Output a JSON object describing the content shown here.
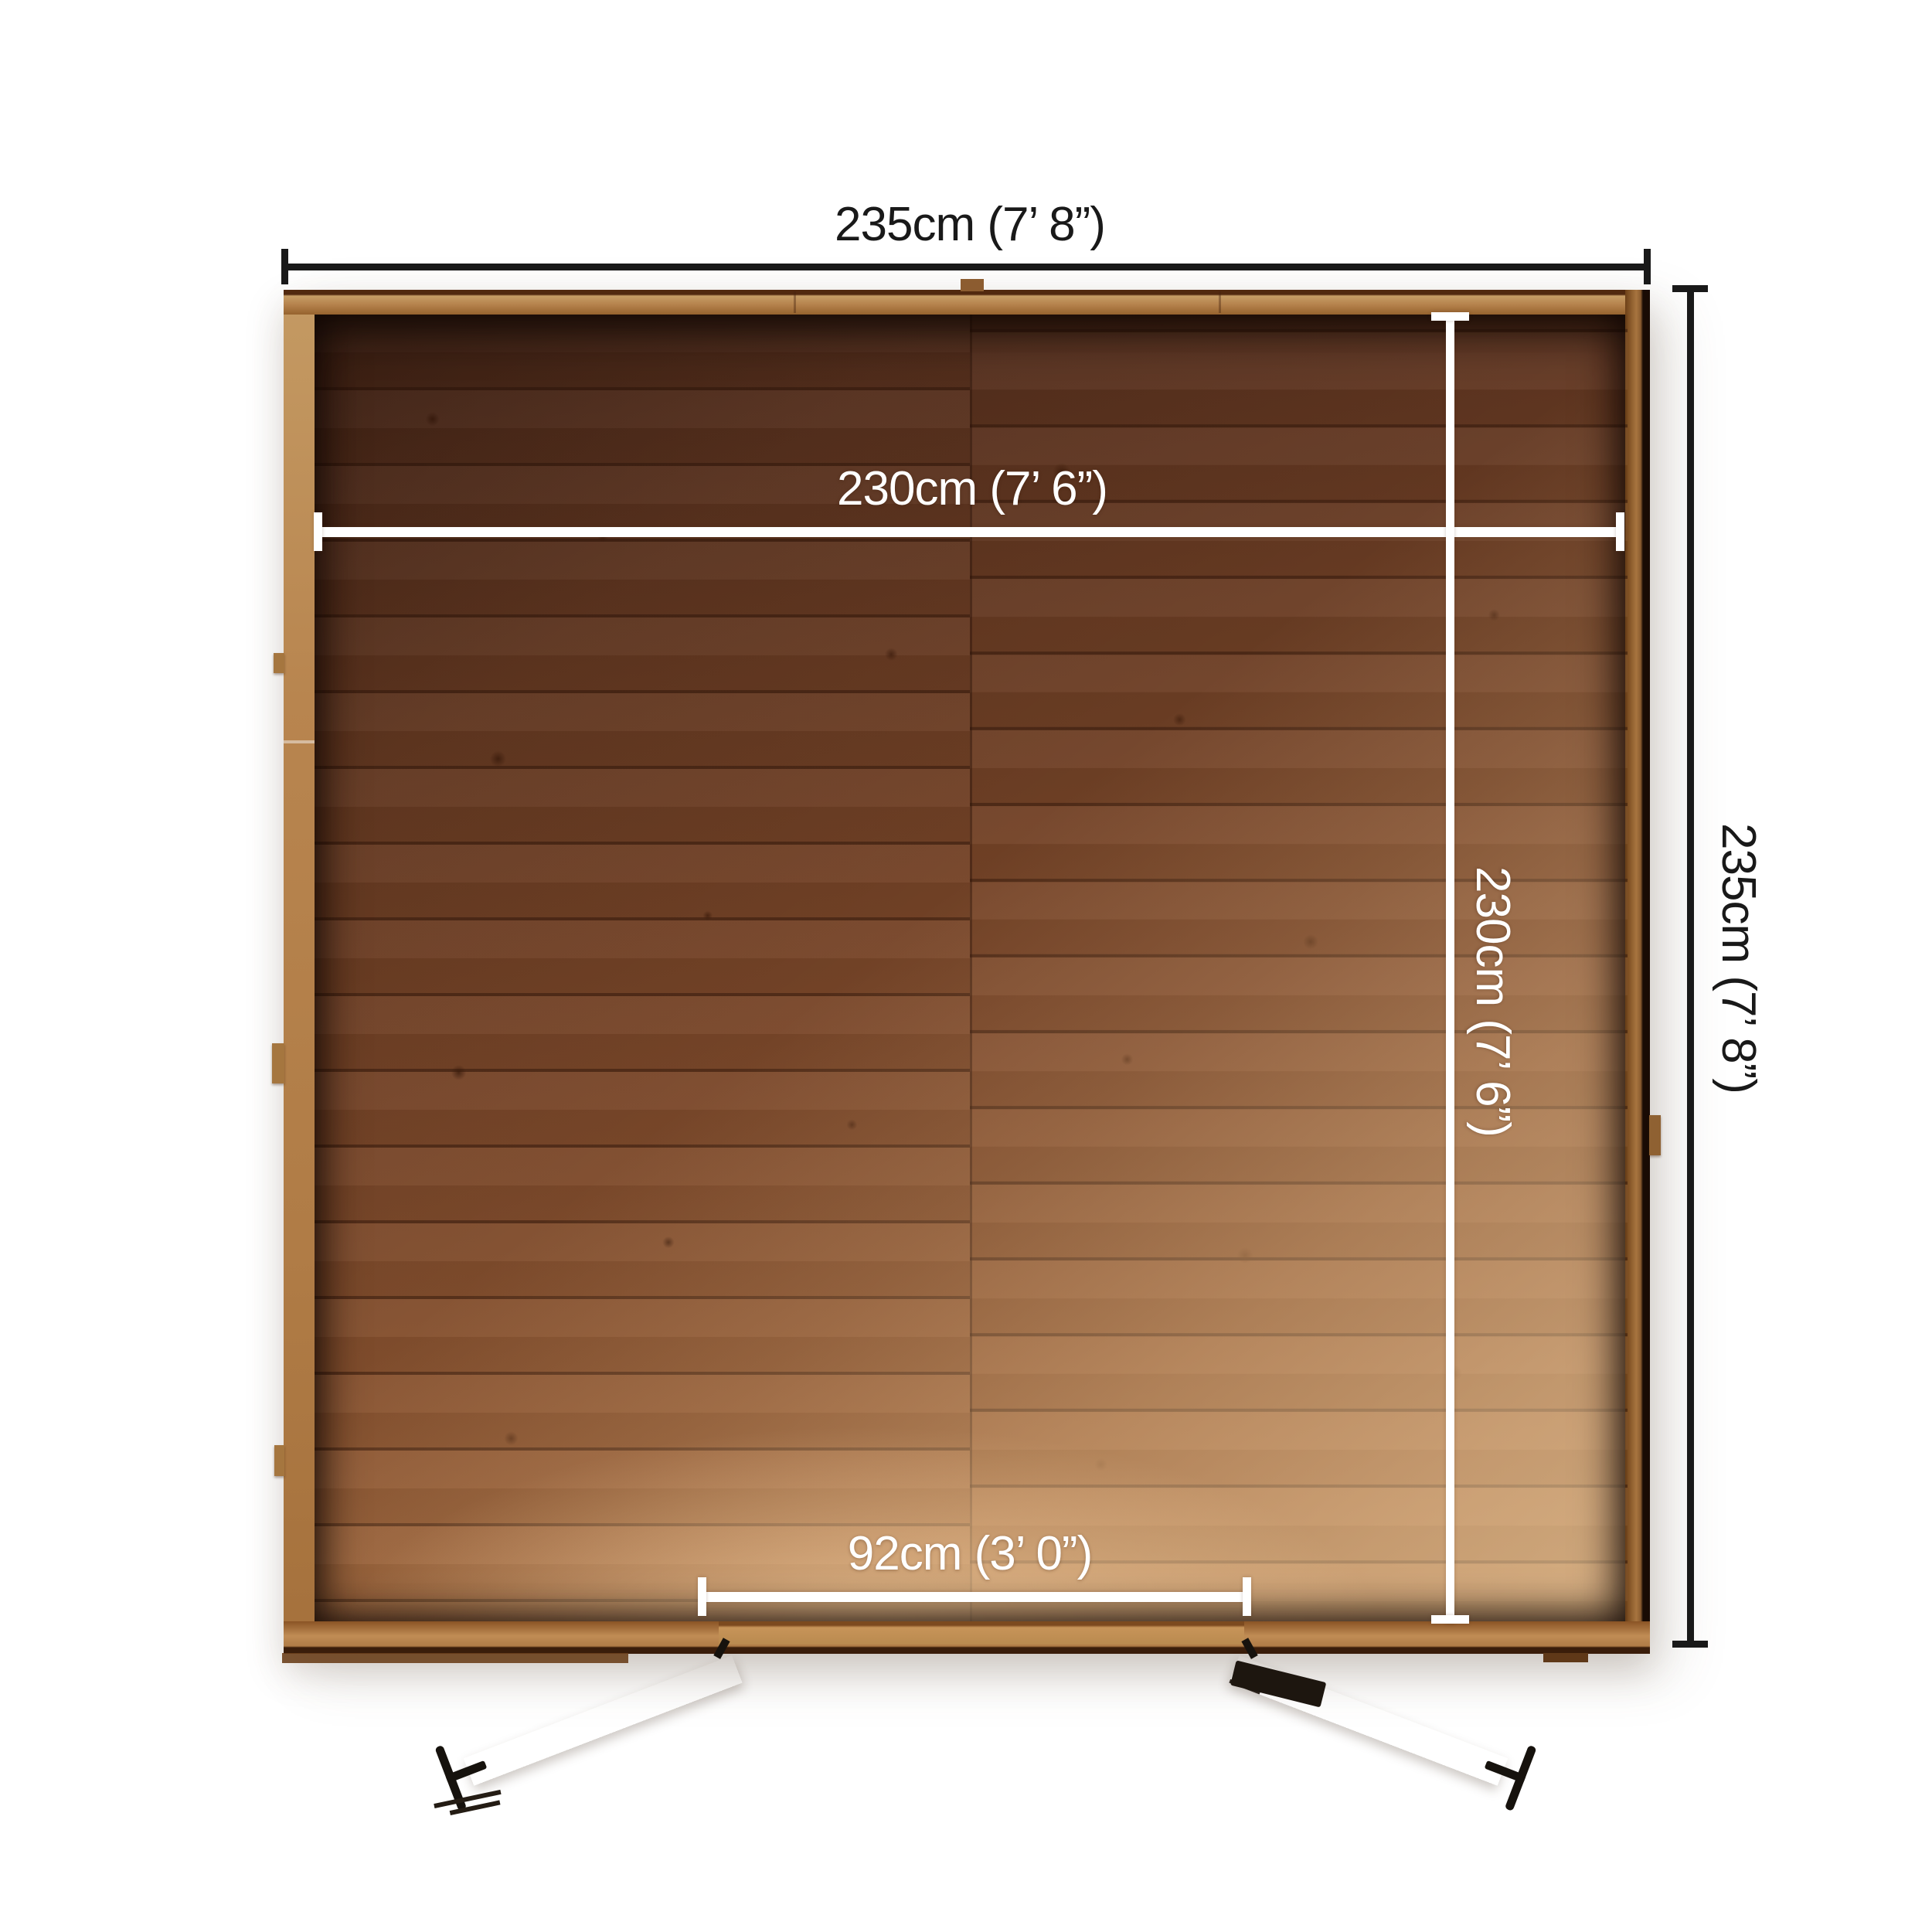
{
  "diagram": {
    "view": "shed-top-down-floor-plan",
    "background_color": "#f1f1f0",
    "outer_dimension_color": "#191919",
    "inner_dimension_color": "#ffffff",
    "wood_colors": {
      "wall_light": "#c49a63",
      "wall_dark": "#6e4118",
      "floor_dark": "#5a311e",
      "floor_mid": "#7c4829",
      "floor_light": "#c99a6b",
      "door": "#ae7944",
      "hardware": "#16120d"
    },
    "dimensions": {
      "outer_width": {
        "label": "235cm (7’ 8”)",
        "position": "top"
      },
      "outer_depth": {
        "label": "235cm (7’ 8”)",
        "position": "right"
      },
      "inner_width": {
        "label": "230cm (7’ 6”)",
        "position": "inside-top"
      },
      "inner_depth": {
        "label": "230cm (7’ 6”)",
        "position": "inside-right"
      },
      "door_opening_width": {
        "label": "92cm (3’ 0”)",
        "position": "inside-bottom"
      },
      "faded_side_depth": {
        "label": "400cm (13’ 1”)",
        "position": "outside-left"
      }
    }
  }
}
